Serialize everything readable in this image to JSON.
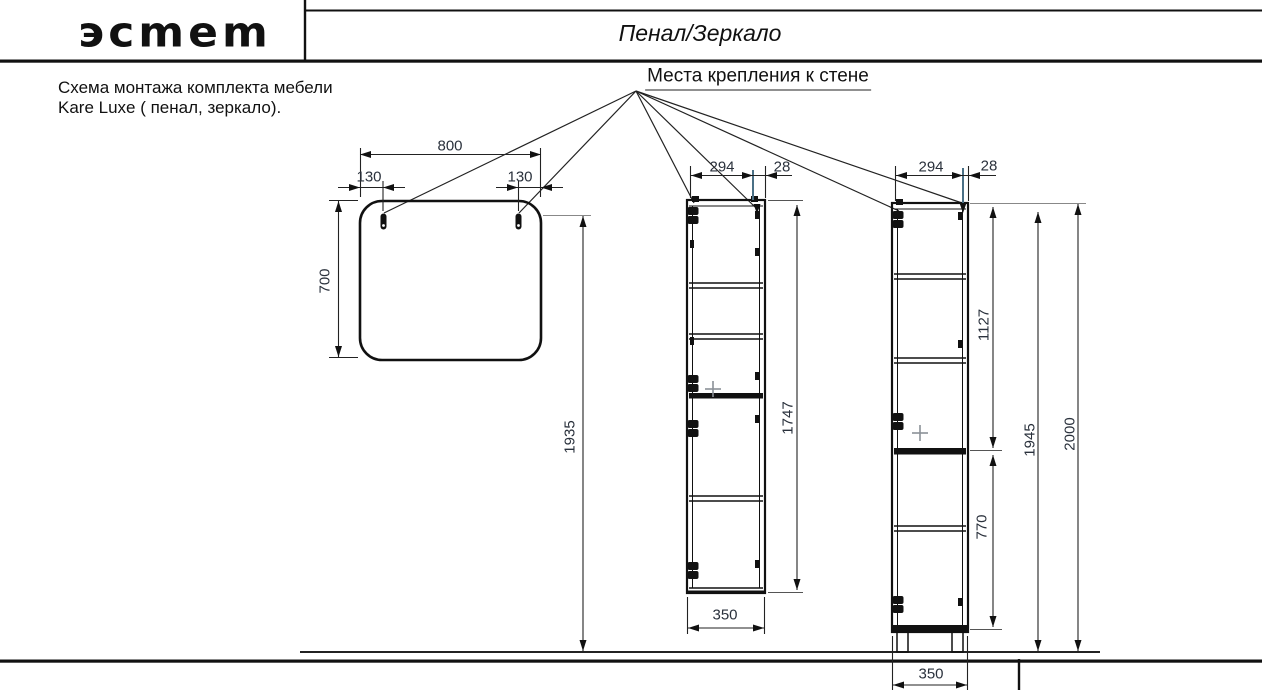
{
  "header": {
    "logo_text": "эсmem",
    "sheet_title": "Пенал/Зеркало"
  },
  "note": {
    "line1": "Схема монтажа комплекта мебели",
    "line2": "Kare Luxe ( пенал, зеркало)."
  },
  "callout": {
    "label": "Места крепления к стене"
  },
  "mirror": {
    "width": "800",
    "hole_offset_left": "130",
    "hole_offset_right": "130",
    "height": "700",
    "mount_height": "1935"
  },
  "wall_cabinet": {
    "mount_offset": "294",
    "edge_gap": "28",
    "body_height": "1747",
    "depth": "350"
  },
  "floor_cabinet": {
    "mount_offset": "294",
    "edge_gap": "28",
    "upper_span": "1127",
    "lower_span": "770",
    "body_height": "1945",
    "total_height": "2000",
    "width": "350"
  },
  "colors": {
    "line": "#1a1a1a",
    "mount_accent": "#4a7086",
    "dim_text": "#2a313c"
  }
}
